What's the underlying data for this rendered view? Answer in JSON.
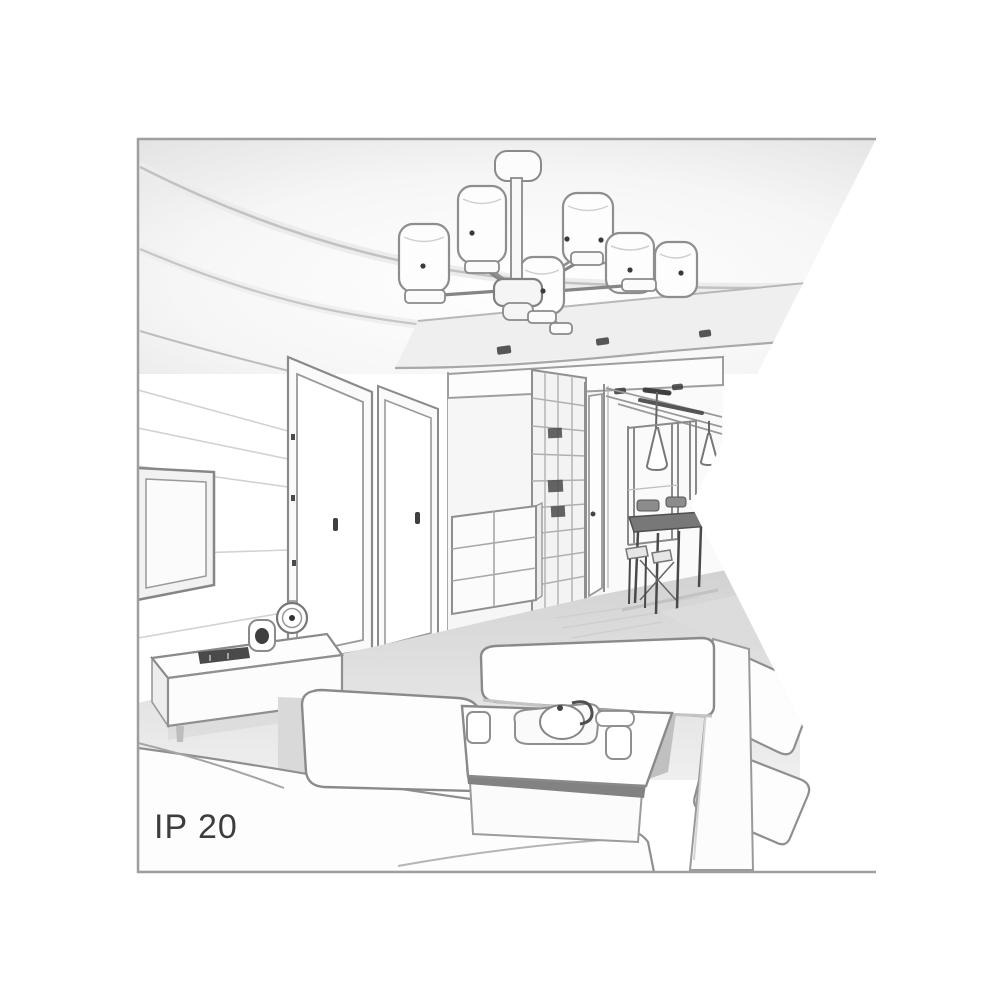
{
  "illustration": {
    "label": "IP 20",
    "type": "interior-room-perspective-sketch",
    "style": "grayscale line drawing of a living room clipped by a triangular notch on the right",
    "colors": {
      "background": "#ffffff",
      "line": "#8f8f8f",
      "dark_accent": "#3c3c3c",
      "shading_light": "#ececec",
      "shading_mid": "#d9d9d9",
      "floor": "#d6d6d6",
      "label_text": "#3d3d3d"
    },
    "elements": [
      "ceiling-chandelier-with-cylinder-shades",
      "recessed-ceiling-spotlights",
      "paneled-tv-wall",
      "flat-screen-tv",
      "media-sideboard",
      "alarm-clock",
      "small-speaker",
      "remote-control",
      "interior-door-left",
      "interior-door-right",
      "hallway-opening",
      "chest-of-drawers",
      "grid-front-wardrobe",
      "hallway-door",
      "cone-pendant-lights",
      "dining-table-with-chairs",
      "window",
      "coffee-table",
      "tea-set-and-cups",
      "left-sofa",
      "ottoman-bench",
      "right-sofa"
    ]
  }
}
